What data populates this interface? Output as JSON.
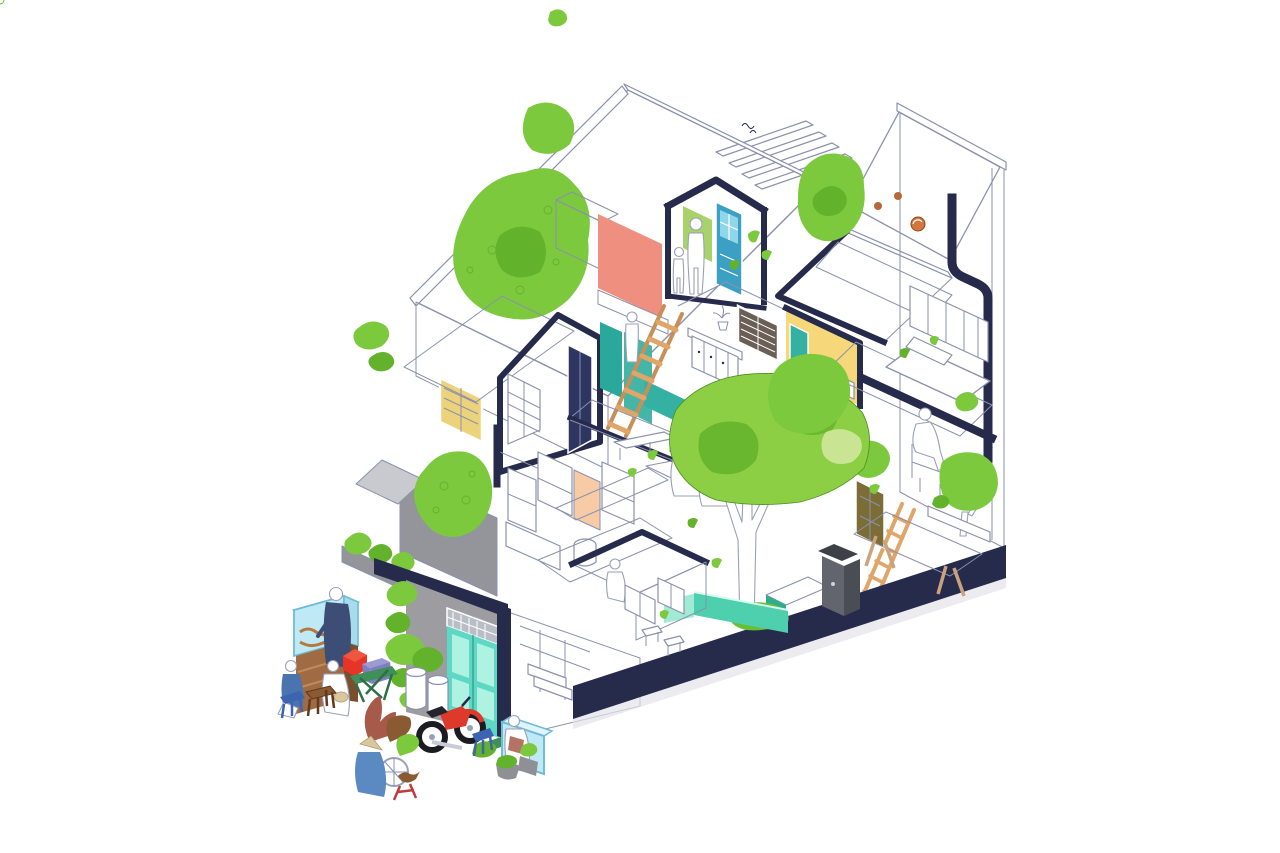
{
  "image": {
    "width": 1280,
    "height": 853,
    "background": "#ffffff",
    "visible_text": "none"
  },
  "illustration": {
    "kind": "axonometric-sectional-cutaway",
    "subject": "hand-drawn cutaway axonometric of a narrow multi-storey tube house with pebble-stone roofs, roof gardens, clay-tile roofs, interior courtyard with tree, and a street scene with food cart, vendors, plants and a motorbike"
  },
  "palette": {
    "navy": "#262a4b",
    "outline": "#8b91ad",
    "figureLine": "#9aa0b8",
    "figureFill": "#ffffff",
    "stoneLine": "#7d86b0",
    "tileBase": "#96613c",
    "tileDark": "#5f3a22",
    "tileLight": "#c99b74",
    "deckBase": "#a8714a",
    "deckLine": "#6f4326",
    "plankBase": "#f3c09a",
    "plankLine": "#dc9b6e",
    "plankPale": "#f6cba6",
    "coral": "#ee8f80",
    "greenWall": "#a8d36b",
    "blueDoor": "#3ba0c4",
    "bluePane": "#8fd6ea",
    "tealWall": "#2aa89c",
    "tealWall2": "#45b5a8",
    "tealPanel": "#35b1a4",
    "mintFrame": "#5ed8c4",
    "mintPane": "#aef2e2",
    "yellowWall": "#f6d77a",
    "yellowShutter": "#ecd27a",
    "shutterBrown": "#6b5e55",
    "navyDoor": "#2e3561",
    "oliveDoor": "#7b6d35",
    "louverGreen": "#4e7f43",
    "treeGreen": "#8ccf45",
    "treeDark": "#63b22c",
    "treeLight": "#c9e593",
    "leafGreen": "#7cc93e",
    "grass": "#67bf35",
    "poolTeal": "#4ecfae",
    "poolLight": "#9febd5",
    "greyWall": "#9d9da1",
    "terraceGrey": "#94959a",
    "shedGrey": "#c9cad0",
    "binGrey": "#63656e",
    "binDark": "#4b4d55",
    "binLid": "#3f4149",
    "tealPlanter": "#42c9a6",
    "tableWood": "#b57c4e",
    "slatLine": "#86572f",
    "peachTable": "#f2b28b",
    "cartGlass": "#bfe9f5",
    "cartGlassLight": "#dff5fb",
    "cartGlassSide": "#a8dcec",
    "cartGlassEdge": "#6fbcd6",
    "cartWood": "#a06b42",
    "cartWoodDark": "#7a4e2e",
    "vendorNavy": "#3c4e75",
    "customerBlue": "#4a74b0",
    "personBlue": "#5b8ac2",
    "stoolBlue": "#3c64b0",
    "stoolWood": "#8a5a33",
    "boxRed": "#e63426",
    "boxRedTop": "#f05542",
    "boxPurple": "#7e7fbe",
    "boxPurpleTop": "#9a9bd0",
    "tableGreen": "#3f8f5a",
    "bikeRed": "#dd3a2c",
    "tire": "#1b1b22",
    "flowerRust": "#a85a4a",
    "hatTan": "#d9c89e",
    "orangeFruit": "#d2763b",
    "ladderWood": "#e0a568",
    "ladderRail": "#c89058",
    "matLine": "#c3c9da",
    "shadow": "#e2e3e9",
    "white": "#ffffff"
  },
  "elements": [
    {
      "name": "stone-roof-left",
      "label": "large pebble-textured roof slope with roof garden"
    },
    {
      "name": "stone-roof-right",
      "label": "pebble-textured roof cap of right tower"
    },
    {
      "name": "pergola-slats",
      "label": "white louver slats over attic"
    },
    {
      "name": "attic-room",
      "label": "attic bedroom with coral wall, blue door and two figures"
    },
    {
      "name": "gable-room-left",
      "label": "cut-open bedroom with navy shuttered door"
    },
    {
      "name": "yellow-window",
      "label": "yellow shuttered window on stone facade"
    },
    {
      "name": "stair-ladder",
      "label": "wooden ship ladder with climbing figure and teal wall"
    },
    {
      "name": "kitchen-upper",
      "label": "upper kitchen with white cabinet and brown louvered window"
    },
    {
      "name": "central-tile-roof",
      "label": "large clay tile roof"
    },
    {
      "name": "yellow-room",
      "label": "yellow room with teal door panel"
    },
    {
      "name": "right-tower",
      "label": "tall right volume with window band, bed and desk nook"
    },
    {
      "name": "courtyard",
      "label": "courtyard with mat, two seated figures and bench"
    },
    {
      "name": "courtyard-tree",
      "label": "large courtyard tree with bright green canopy"
    },
    {
      "name": "pool",
      "label": "teal water strip"
    },
    {
      "name": "trash-bin",
      "label": "dark grey bin"
    },
    {
      "name": "teal-planter",
      "label": "teal planter box"
    },
    {
      "name": "orange-ladder",
      "label": "orange wooden ladder"
    },
    {
      "name": "olive-door",
      "label": "olive panel door"
    },
    {
      "name": "trestle-table",
      "label": "large peach trestle table"
    },
    {
      "name": "kitchen-lower",
      "label": "ground-floor kitchen under small tile roof"
    },
    {
      "name": "living-furniture",
      "label": "white line-drawn shelving and furniture"
    },
    {
      "name": "terrace-left",
      "label": "grey terrace with textured tree"
    },
    {
      "name": "street-facade",
      "label": "grey street facade with mint double door and vertical garden"
    },
    {
      "name": "ground-plinth",
      "label": "thick navy ground slab cut"
    },
    {
      "name": "food-cart",
      "label": "street food cart with glass display"
    },
    {
      "name": "vendor",
      "label": "vendor in navy shirt"
    },
    {
      "name": "customers",
      "label": "two seated customers on stools"
    },
    {
      "name": "plastic-stools",
      "label": "blue and wooden street stools"
    },
    {
      "name": "red-box",
      "label": "red cooler box"
    },
    {
      "name": "purple-box",
      "label": "purple box table"
    },
    {
      "name": "street-pots",
      "label": "white plant pots with shrubs"
    },
    {
      "name": "motorbike",
      "label": "red and white motorbike"
    },
    {
      "name": "flower-bicycle",
      "label": "flower vendor bicycle with conical-hat seller"
    },
    {
      "name": "fish-tank",
      "label": "glass fish tank with seated keeper"
    },
    {
      "name": "scattered-leaves",
      "label": "falling green leaves"
    }
  ]
}
